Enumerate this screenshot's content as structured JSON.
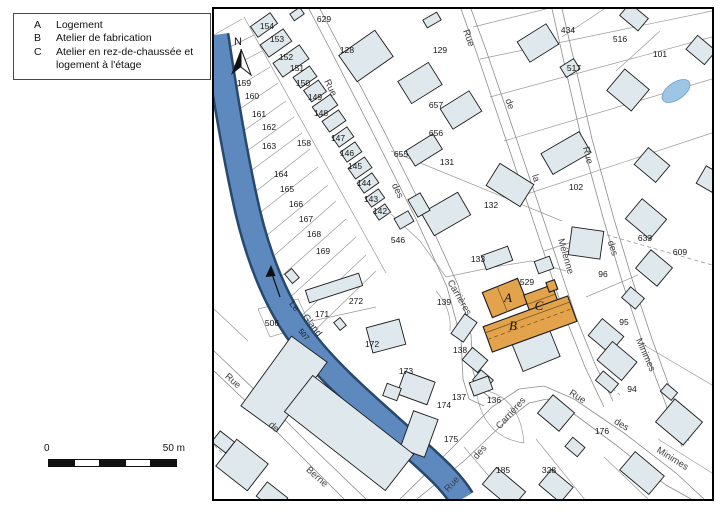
{
  "legend": {
    "items": [
      {
        "key": "A",
        "label": "Logement"
      },
      {
        "key": "B",
        "label": "Atelier de fabrication"
      },
      {
        "key": "C",
        "label": "Atelier en rez-de-chaussée et logement à l'étage"
      }
    ]
  },
  "scale": {
    "zero": "0",
    "max": "50 m"
  },
  "compass": {
    "north": "N"
  },
  "river": {
    "le": "Le",
    "gland": "Gland"
  },
  "streets": {
    "rue": "Rue",
    "de": "de",
    "des": "des",
    "la": "la",
    "carrieres": "Carrières",
    "melenne": "Mélenne",
    "minimes": "Minimes",
    "berne": "Berne"
  },
  "highlight": {
    "a": "A",
    "b": "B",
    "c": "C"
  },
  "parcels": {
    "94": "94",
    "95": "95",
    "96": "96",
    "101": "101",
    "102": "102",
    "128": "128",
    "129": "129",
    "131": "131",
    "132": "132",
    "133": "133",
    "136": "136",
    "137": "137",
    "138": "138",
    "139": "139",
    "142": "142",
    "143": "143",
    "144": "144",
    "145": "145",
    "146": "146",
    "147": "147",
    "148": "148",
    "149": "149",
    "150": "150",
    "151": "151",
    "152": "152",
    "153": "153",
    "154": "154",
    "158": "158",
    "159": "159",
    "160": "160",
    "161": "161",
    "162": "162",
    "163": "163",
    "164": "164",
    "165": "165",
    "166": "166",
    "167": "167",
    "168": "168",
    "169": "169",
    "171": "171",
    "172": "172",
    "173": "173",
    "174": "174",
    "175": "175",
    "176": "176",
    "185": "185",
    "272": "272",
    "328": "328",
    "434": "434",
    "506": "506",
    "507": "507",
    "516": "516",
    "517": "517",
    "529": "529",
    "546": "546",
    "609": "609",
    "629": "629",
    "633": "633",
    "655": "655",
    "656": "656",
    "657": "657"
  },
  "colors": {
    "highlight_orange": "#e2a34c",
    "river_blue": "#5d89bf",
    "building_fill": "#dfe8ec"
  }
}
